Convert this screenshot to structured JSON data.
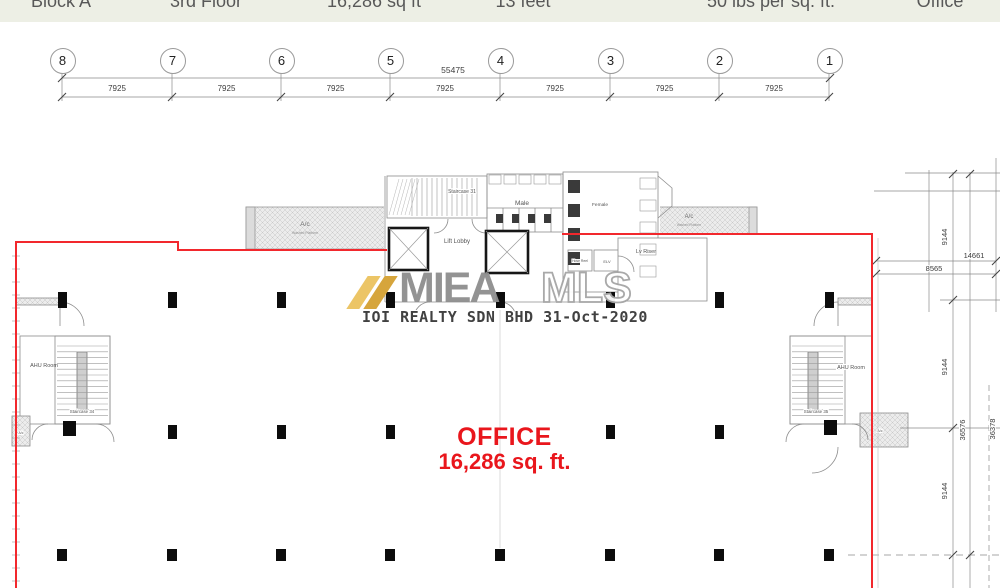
{
  "header": {
    "cells": [
      {
        "label": "Block A"
      },
      {
        "label": "3rd Floor"
      },
      {
        "label": "16,286 sq ft"
      },
      {
        "label": "13 feet"
      },
      {
        "label": "50 lbs per sq. ft."
      },
      {
        "label": "Office"
      }
    ]
  },
  "grid": {
    "bubbles": [
      "8",
      "7",
      "6",
      "5",
      "4",
      "3",
      "2",
      "1"
    ],
    "overall_dim": "55475",
    "bay_dims": [
      "7925",
      "7925",
      "7925",
      "7925",
      "7925",
      "7925",
      "7925"
    ]
  },
  "plan": {
    "core": {
      "staircase_top": "Staircase 31",
      "male": "Male",
      "female": "Female",
      "lift_lobby": "Lift Lobby",
      "hose_reel": "Hose Reel",
      "elv": "ELV",
      "lv_riser": "Lv Riser"
    },
    "ledge_left": {
      "title": "A/c",
      "subtitle": "Washed Platform"
    },
    "ledge_right": {
      "title": "A/c",
      "subtitle": "Washed Platform"
    },
    "left_wing": {
      "ahu": "AHU Room",
      "staircase": "Staircase 34",
      "ac": "A/c"
    },
    "right_wing": {
      "ahu": "AHU Room",
      "staircase": "Staircase 35",
      "ac": "A/c"
    },
    "office": {
      "line1": "OFFICE",
      "line2": "16,286 sq. ft."
    }
  },
  "dimensions": {
    "right": {
      "seg1": "9144",
      "offset_a": "14661",
      "offset_b": "8565",
      "seg2": "9144",
      "total": "36576",
      "outer_total": "36378",
      "seg3": "9144"
    }
  },
  "watermark": {
    "brand_bold": "MIEA",
    "brand_outline": "MLS",
    "footer": "IOI REALTY SDN BHD 31-Oct-2020"
  },
  "colors": {
    "boundary_red": "#F2282D",
    "office_text_red": "#E9161C",
    "watermark_gold": "#D6A53C",
    "header_bg": "#EDEFE5"
  }
}
